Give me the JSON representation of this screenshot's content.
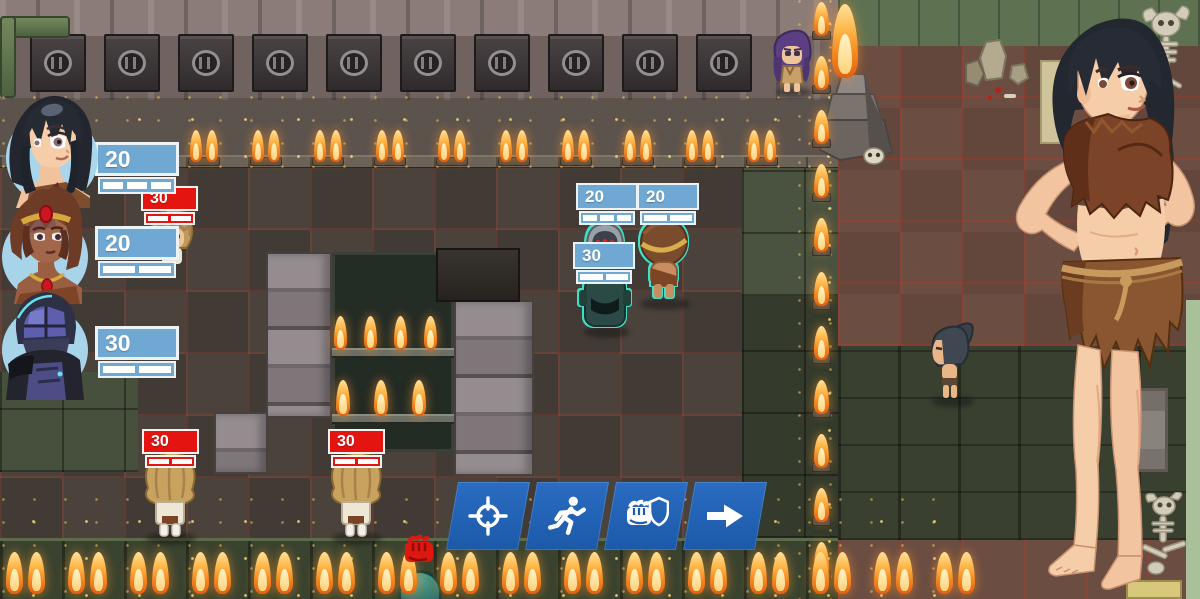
{
  "hud": {
    "health_bars": [
      {
        "id": "party-slot-1",
        "value": "20",
        "team": "ally",
        "segments": 3
      },
      {
        "id": "party-slot-2",
        "value": "20",
        "team": "ally",
        "segments": 2
      },
      {
        "id": "party-slot-3",
        "value": "30",
        "team": "ally",
        "segments": 2
      },
      {
        "id": "enemy-upper",
        "value": "30",
        "team": "enemy",
        "segments": 2
      },
      {
        "id": "drone-unit",
        "value": "20",
        "team": "ally",
        "segments": 3
      },
      {
        "id": "native-unit",
        "value": "20",
        "team": "ally",
        "segments": 2
      },
      {
        "id": "drone-unit-lower",
        "value": "30",
        "team": "ally",
        "segments": 2
      },
      {
        "id": "enemy-lower-left",
        "value": "30",
        "team": "enemy",
        "segments": 2
      },
      {
        "id": "enemy-lower-mid",
        "value": "30",
        "team": "enemy",
        "segments": 2
      }
    ],
    "action_bar": {
      "buttons": [
        {
          "id": "target",
          "icon": "crosshair-icon"
        },
        {
          "id": "move",
          "icon": "run-icon"
        },
        {
          "id": "attack",
          "icon": "fist-shield-icon"
        },
        {
          "id": "end-turn",
          "icon": "arrow-right-icon"
        }
      ]
    },
    "indicators": [
      {
        "id": "melee-attack",
        "icon": "fist-icon"
      }
    ],
    "portraits": [
      {
        "id": "portrait-1",
        "label": "black-haired woman"
      },
      {
        "id": "portrait-2",
        "label": "tribal woman with circlet"
      },
      {
        "id": "portrait-3",
        "label": "armored trooper"
      }
    ]
  },
  "colors": {
    "ally_bar": "#6fa8d2",
    "enemy_bar": "#e41410",
    "action_button": "#1d5cad",
    "selection_outline": "#3fe0c6",
    "flame_core": "#ffd27a"
  }
}
